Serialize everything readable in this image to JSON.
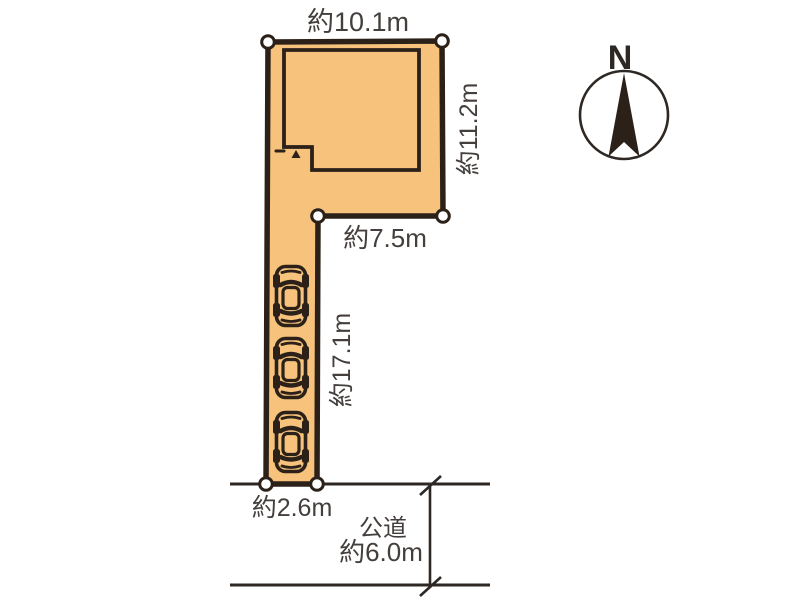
{
  "diagram": {
    "title": "敷地区画図",
    "dimensions": {
      "top_width": "約10.1m",
      "right_height": "約11.2m",
      "inner_width": "約7.5m",
      "driveway_length": "約17.1m",
      "frontage": "約2.6m"
    },
    "road": {
      "name": "公道",
      "width": "約6.0m"
    },
    "compass": {
      "north_label": "N"
    },
    "counts": {
      "cars": 3,
      "boundary_markers": 6
    },
    "colors": {
      "land_fill": "#f6c27c",
      "outline": "#2b2119",
      "line": "#2e2824",
      "text": "#443f3c",
      "marker_fill": "#ffffff"
    }
  }
}
